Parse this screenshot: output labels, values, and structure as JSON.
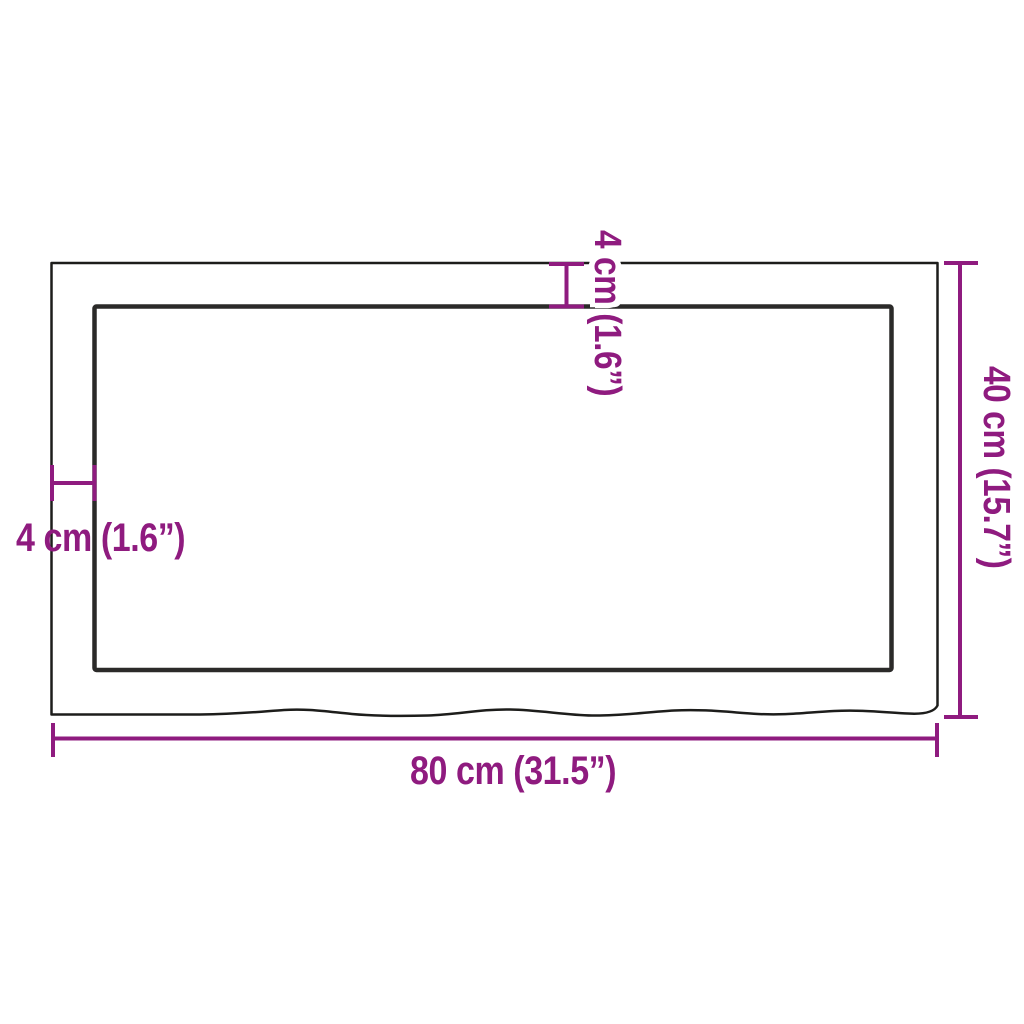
{
  "diagram": {
    "background": "#ffffff",
    "outline_color": "#1d1d1b",
    "inner_outline_color": "#2b2a29",
    "accent_color": "#8f1b7f",
    "labels": {
      "width_bottom": "80 cm (31.5”)",
      "height_right": "40 cm (15.7”)",
      "thickness_top": "4 cm (1.6”)",
      "thickness_left": "4 cm (1.6”)"
    }
  }
}
